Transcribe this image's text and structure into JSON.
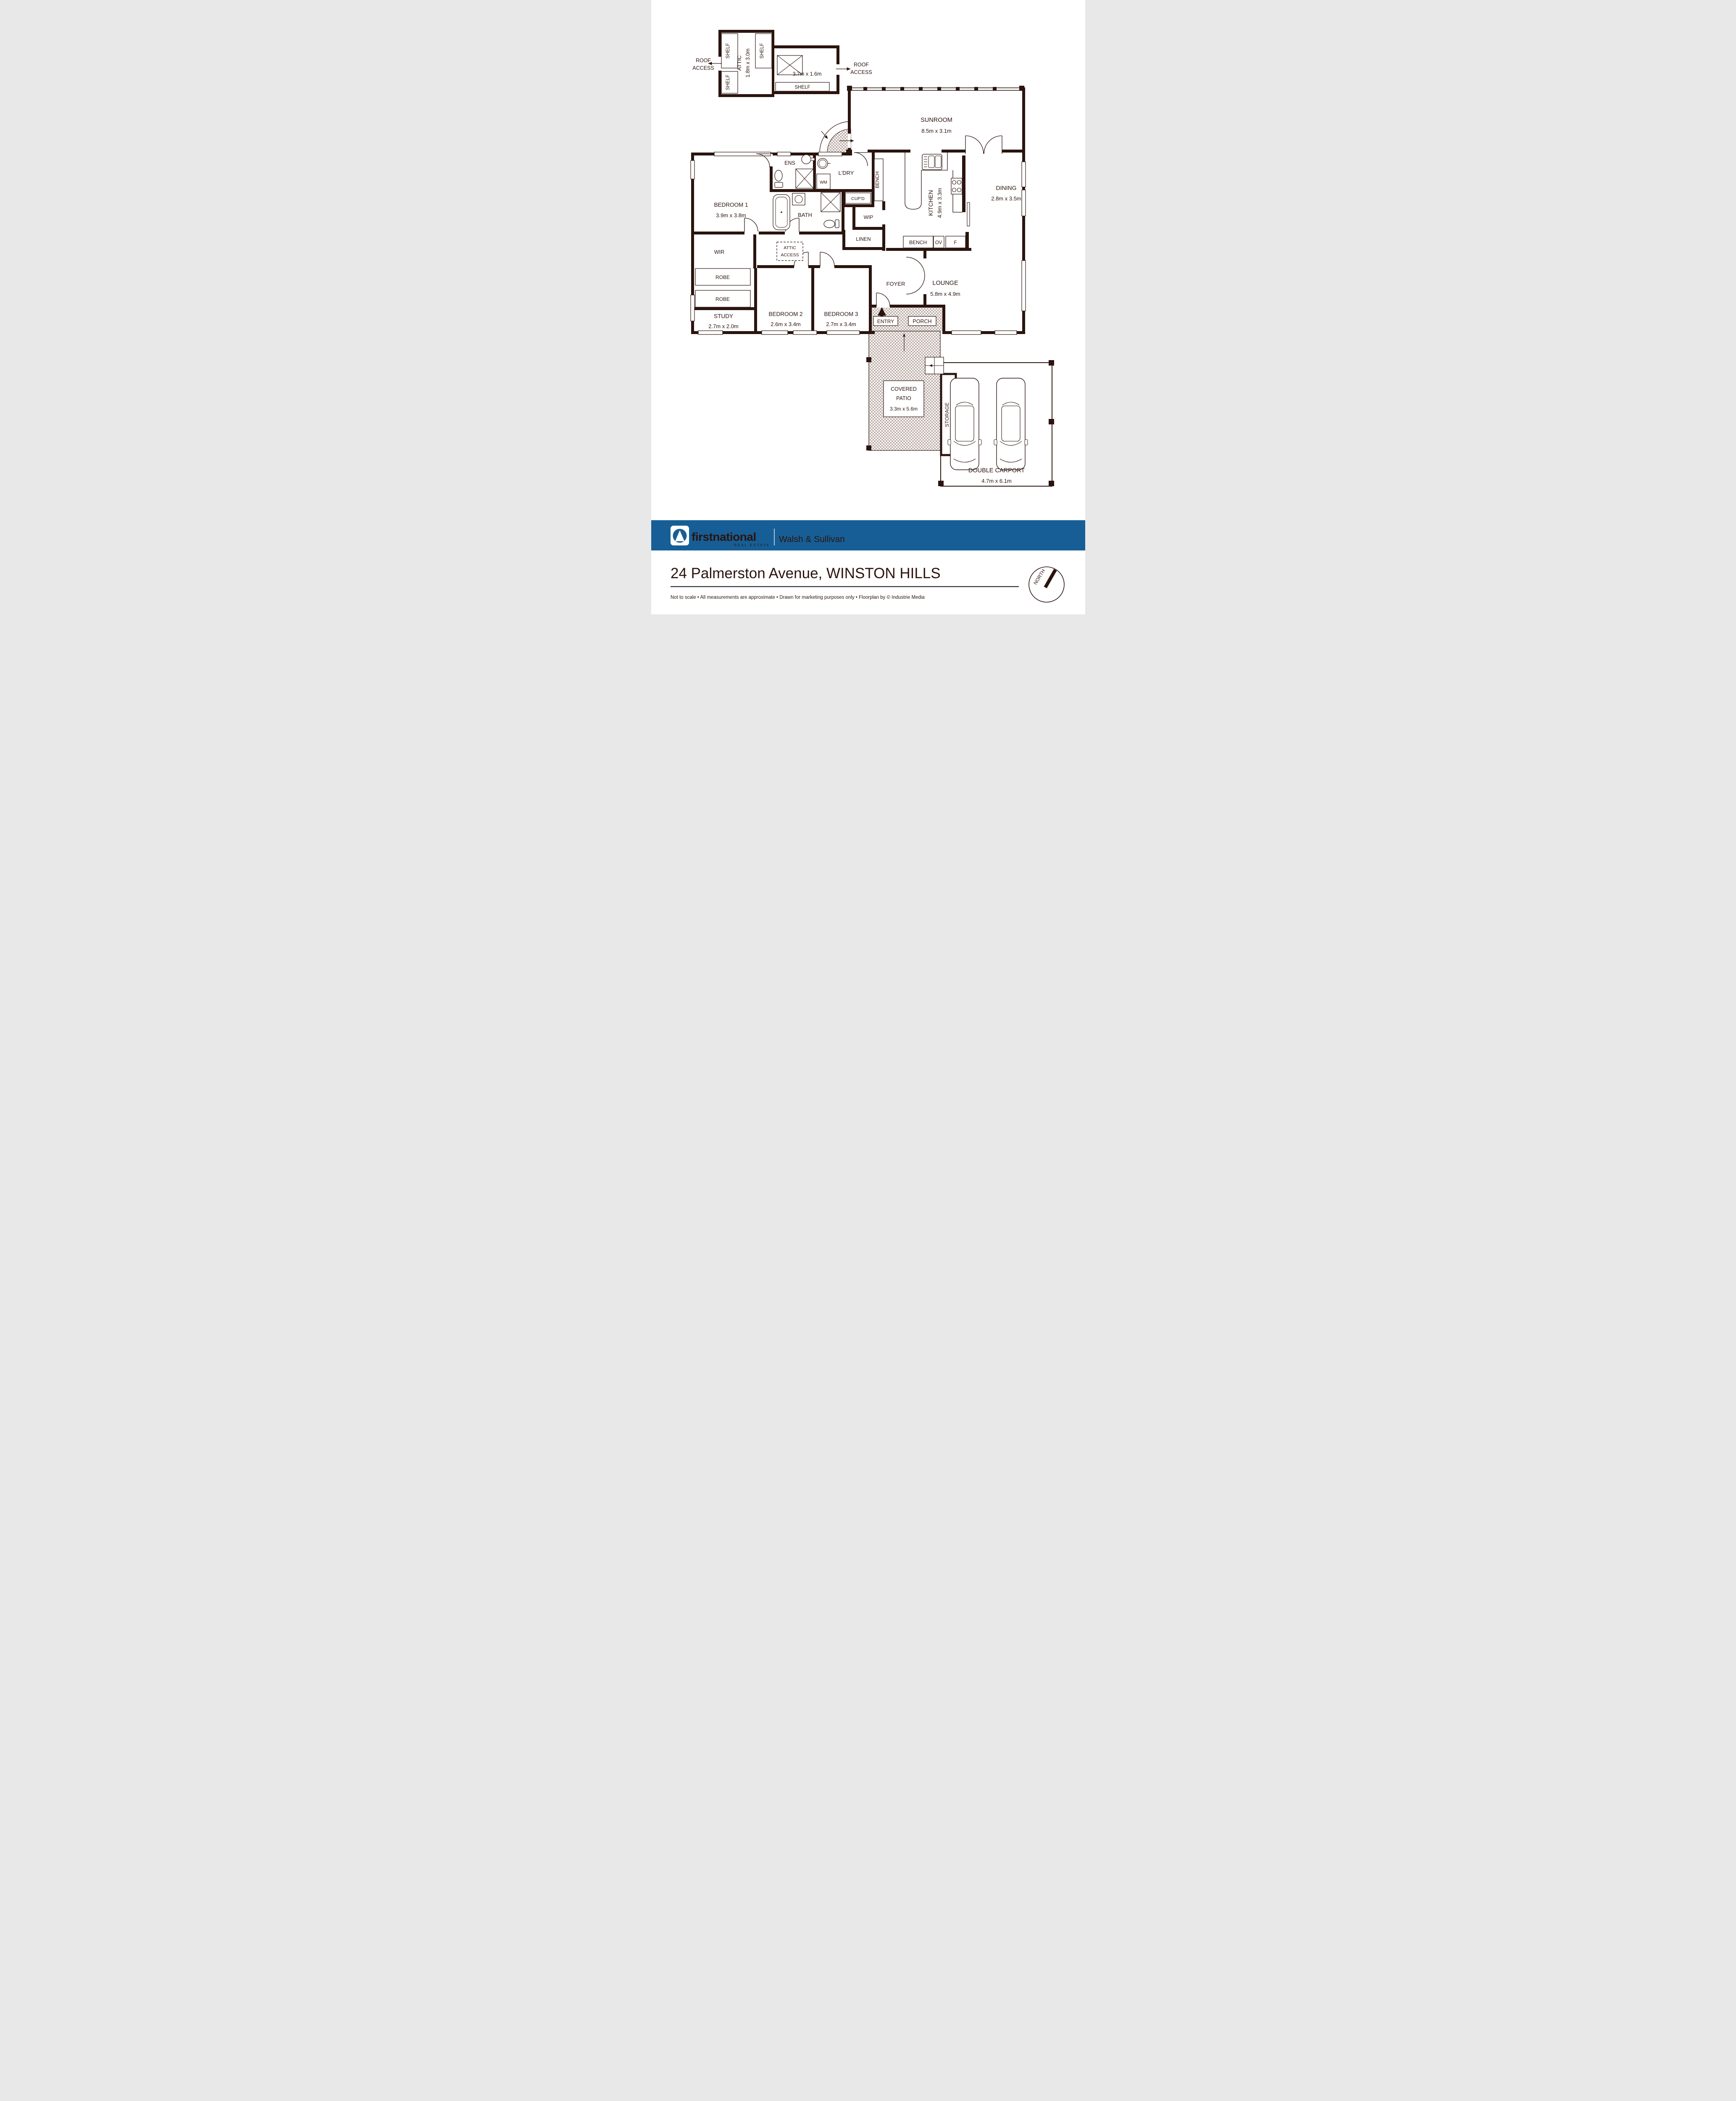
{
  "colors": {
    "wall": "#2b140e",
    "accent_blue": "#175e96",
    "text_gray": "#3a3a3a"
  },
  "attic": {
    "name": "ATTIC",
    "dims": "1.8m x 3.0m",
    "wing_dims": "3.7m x 1.6m",
    "shelf": "SHELF",
    "roof_access_line1": "ROOF",
    "roof_access_line2": "ACCESS"
  },
  "rooms": {
    "sunroom": {
      "name": "SUNROOM",
      "dims": "8.5m x 3.1m"
    },
    "kitchen": {
      "name": "KITCHEN",
      "dims": "4.9m x 3.3m"
    },
    "dining": {
      "name": "DINING",
      "dims": "2.8m x 3.5m"
    },
    "lounge": {
      "name": "LOUNGE",
      "dims": "5.8m x 4.9m"
    },
    "bedroom1": {
      "name": "BEDROOM 1",
      "dims": "3.9m x 3.8m"
    },
    "bedroom2": {
      "name": "BEDROOM 2",
      "dims": "2.6m x 3.4m"
    },
    "bedroom3": {
      "name": "BEDROOM 3",
      "dims": "2.7m x 3.4m"
    },
    "study": {
      "name": "STUDY",
      "dims": "2.7m x 2.0m"
    },
    "ens": {
      "name": "ENS"
    },
    "laundry": {
      "name": "L'DRY"
    },
    "bath": {
      "name": "BATH"
    },
    "wip": {
      "name": "WIP"
    },
    "linen": {
      "name": "LINEN"
    },
    "cupboard": {
      "name": "CUP'D"
    },
    "bench": {
      "name": "BENCH"
    },
    "wir": {
      "name": "WIR"
    },
    "robe": {
      "name": "ROBE"
    },
    "foyer": {
      "name": "FOYER"
    },
    "entry": {
      "name": "ENTRY"
    },
    "porch": {
      "name": "PORCH"
    },
    "covered_patio": {
      "line1": "COVERED",
      "line2": "PATIO",
      "dims": "3.3m x 5.6m"
    },
    "storage": {
      "name": "STORAGE"
    },
    "carport": {
      "name": "DOUBLE CARPORT",
      "dims": "4.7m x 6.1m"
    },
    "attic_access": {
      "line1": "ATTIC",
      "line2": "ACCESS"
    }
  },
  "fixtures": {
    "wm": "WM",
    "oven": "OV",
    "fridge": "F"
  },
  "compass": {
    "label": "NORTH"
  },
  "footer": {
    "brand": "firstnational",
    "brand_sub": "REAL ESTATE",
    "office": "Walsh & Sullivan",
    "address": "24 Palmerston Avenue, WINSTON HILLS",
    "disclaimer": "Not to scale   •   All measurements are approximate   •   Drawn for marketing purposes only   •   Floorplan by © Industrie Media"
  }
}
